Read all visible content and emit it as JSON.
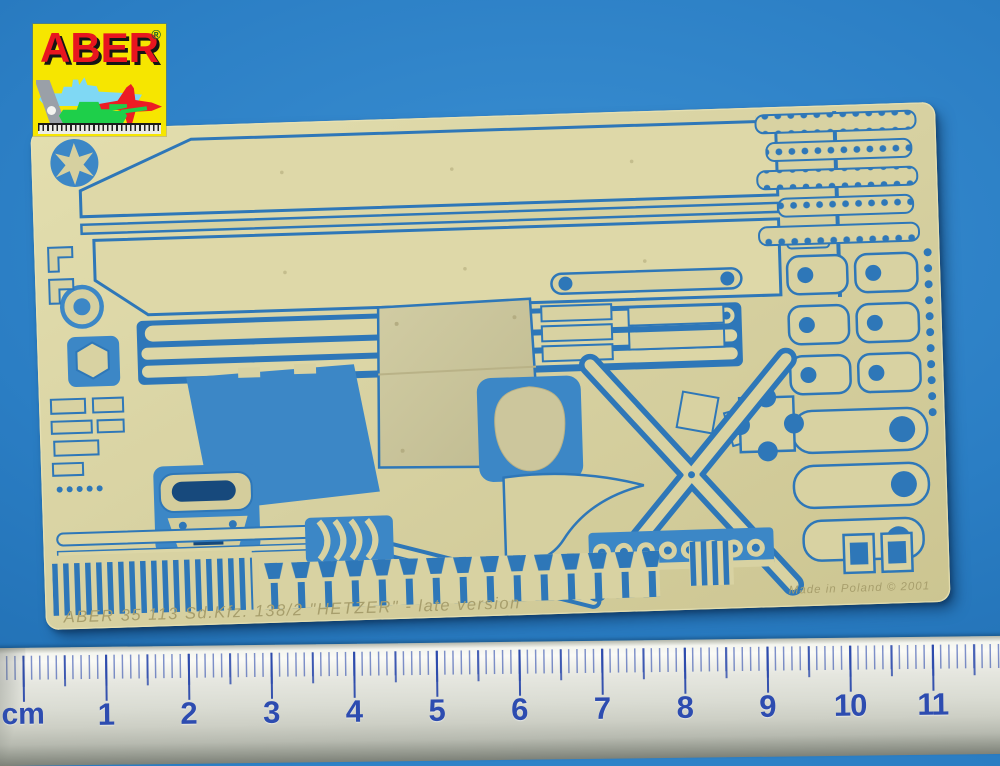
{
  "photo": {
    "background_color": "#2b7ec4",
    "logo": {
      "brand": "ABER",
      "registered": "®",
      "icons": {
        "ship": "battleship-silhouette",
        "jet": "fighter-jet-silhouette",
        "tank": "tank-silhouette",
        "square": "set-square-tool",
        "ruler": "mini-ruler-strip"
      },
      "colors": {
        "background": "#f6e600",
        "brand_text": "#e8151f"
      }
    },
    "fret": {
      "emblem": "aber-star-emblem",
      "etch_text": "ABER   35 113   Sd.Kfz. 138/2 \"HETZER\" - late version",
      "made_in": "Made in Poland  © 2001",
      "brass_color": "#d8d2a2",
      "cutout_color": "#2e77b8"
    },
    "ruler": {
      "unit_label": "cm",
      "numbers": [
        "1",
        "2",
        "3",
        "4",
        "5",
        "6",
        "7",
        "8",
        "9",
        "10",
        "11",
        "12"
      ],
      "number_color": "#2d4cb0",
      "start_x": 27,
      "cm_step_px": 82.7
    }
  }
}
